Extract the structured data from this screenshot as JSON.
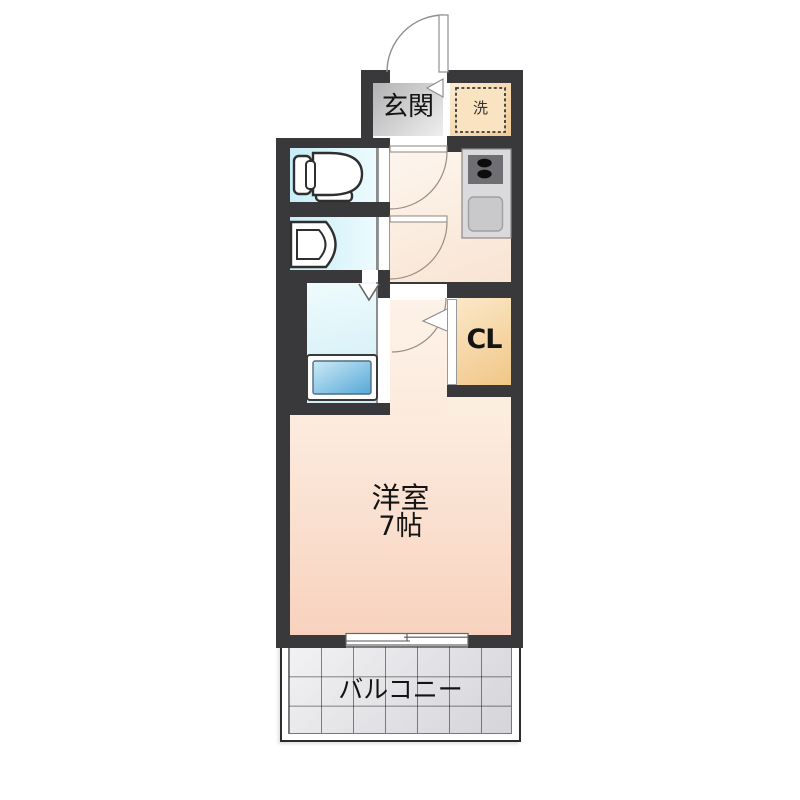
{
  "floorplan": {
    "rooms": {
      "genkan": {
        "label": "玄関"
      },
      "laundry": {
        "label": "洗"
      },
      "closet": {
        "label": "CL"
      },
      "main_room": {
        "label": "洋室",
        "size": "7帖"
      },
      "balcony": {
        "label": "バルコニー"
      }
    },
    "fixtures": [
      "toilet",
      "washbasin",
      "bathtub",
      "kitchen-stove",
      "kitchen-sink",
      "washing-machine-space",
      "entrance-door",
      "sliding-window"
    ],
    "colors": {
      "wall": "#39393b",
      "main_room_pink": "#f8d2be",
      "kitchen_cream": "#f8e2cf",
      "wet_area_blue": "#cdeef7",
      "closet_orange": "#f1c687",
      "laundry_orange": "#f1cb96",
      "genkan_gray": "#b5b5b7",
      "bathtub_blue": "#58a8d8",
      "balcony_tile": "#e8e8ea"
    }
  }
}
